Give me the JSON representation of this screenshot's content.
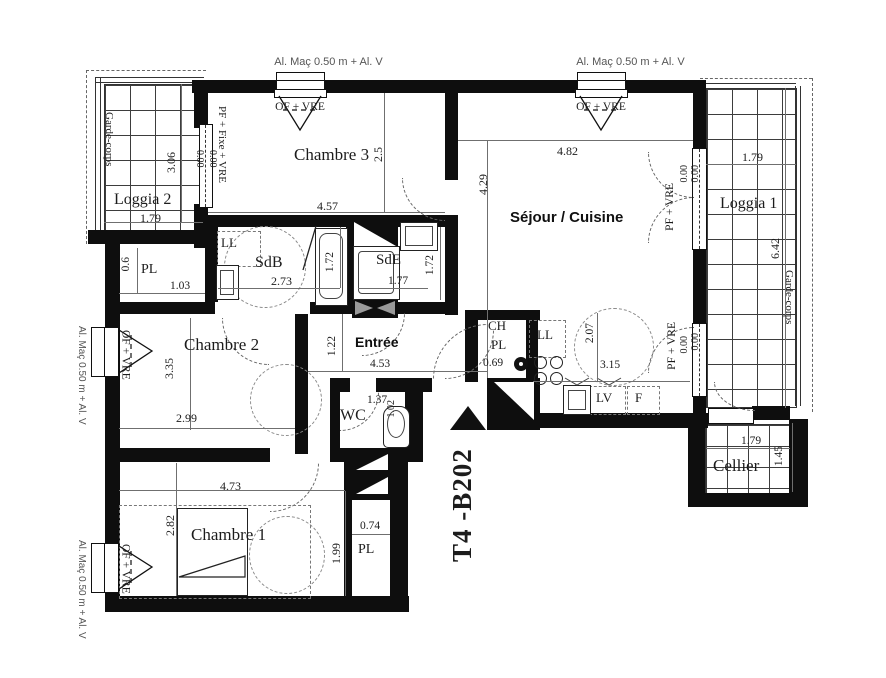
{
  "plan": {
    "unit": {
      "id": "T4 -B202"
    },
    "rooms": {
      "loggia2": {
        "label": "Loggia 2",
        "w": "1.79",
        "h": "3.06"
      },
      "chambre3": {
        "label": "Chambre 3",
        "w": "4.57",
        "h": "2.5"
      },
      "sejour": {
        "label": "Séjour / Cuisine",
        "w": "4.82",
        "h": "4.29"
      },
      "loggia1": {
        "label": "Loggia 1",
        "w": "1.79",
        "h": "6.42"
      },
      "sdb": {
        "label": "SdB",
        "w": "2.73",
        "h": "1.72",
        "ll": "LL"
      },
      "sde": {
        "label": "SdE",
        "w": "1.77",
        "h": "1.72"
      },
      "pl_haut": {
        "label": "PL",
        "w": "1.03",
        "h": "0.6"
      },
      "chambre2": {
        "label": "Chambre 2",
        "w": "2.99",
        "h": "3.35"
      },
      "entree": {
        "label": "Entrée",
        "w": "4.53",
        "h": "1.22"
      },
      "ch_pl": {
        "line1": "CH",
        "line2": "PL",
        "w": "0.69"
      },
      "cuisine": {
        "ll": "LL",
        "lv": "LV",
        "f": "F",
        "w": "3.15",
        "h": "2.07"
      },
      "wc": {
        "label": "WC",
        "w": "1.37",
        "h": "1.02"
      },
      "chambre1": {
        "label": "Chambre 1",
        "w": "4.73",
        "h": "2.82",
        "h2": "1.99"
      },
      "pl_bas": {
        "label": "PL",
        "w": "0.74"
      },
      "cellier": {
        "label": "Cellier",
        "w": "1.79",
        "h": "1.45"
      }
    },
    "annotations": {
      "al_mac": "Al. Maç 0.50 m + Al. V",
      "of_vre": "OF + VRE",
      "pf_fixe_vre": "PF + Fixe + VRE",
      "pf_vre": "PF + VRE",
      "zero": "0.00",
      "garde_corps": "Garde-corps"
    },
    "colors": {
      "wall": "#0e0e0e",
      "dim": "#6f6f6f",
      "muted_text": "#555"
    }
  }
}
